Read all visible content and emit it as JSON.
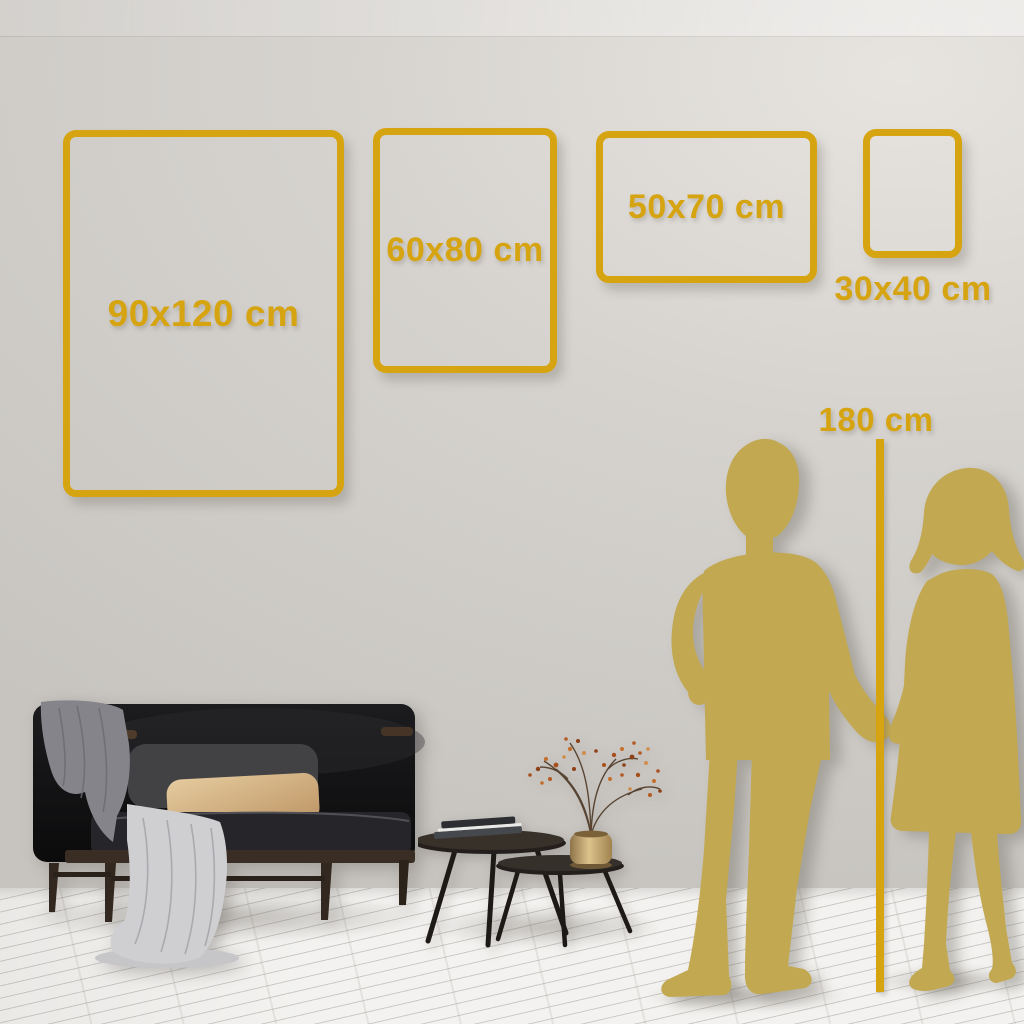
{
  "size_guide": {
    "frames": [
      {
        "label": "90x120 cm",
        "width_cm": 90,
        "height_cm": 120,
        "orientation": "portrait"
      },
      {
        "label": "60x80 cm",
        "width_cm": 60,
        "height_cm": 80,
        "orientation": "portrait"
      },
      {
        "label": "50x70 cm",
        "width_cm": 50,
        "height_cm": 70,
        "orientation": "landscape"
      },
      {
        "label": "30x40 cm",
        "width_cm": 30,
        "height_cm": 40,
        "orientation": "portrait"
      }
    ],
    "height_reference": {
      "label": "180 cm"
    }
  },
  "colors": {
    "accent_gold": "#d7a411",
    "silhouette_gold": "#c2a851",
    "wall_light": "#e7e4e0",
    "wall_dark": "#c7c4c0",
    "floor": "#f3f2f0",
    "sofa_black": "#141416",
    "wood_brown": "#3a2d23",
    "pillow_gray": "#424245",
    "pillow_beige": "#d7b486",
    "blanket_gray": "#84848a",
    "throw_light": "#cfcfd2",
    "vase_brass": "#c7ab72",
    "berry_rust": "#b35a22"
  },
  "scene_objects": {
    "couple": "man-and-woman-silhouette-holding-hands",
    "ruler": "vertical-height-ruler",
    "sofa": "dark-velvet-sofa-with-blankets-and-pillows",
    "tables": "nesting-coffee-tables-with-books",
    "plant": "brass-vase-with-dried-berry-branches"
  }
}
